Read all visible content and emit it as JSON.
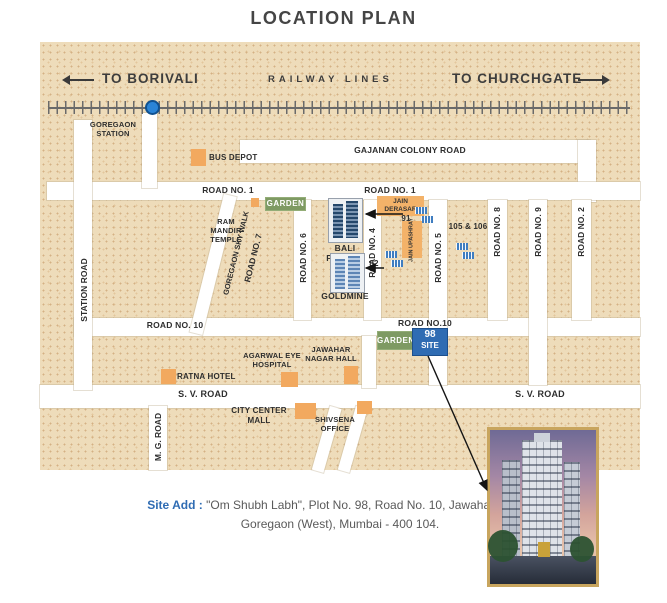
{
  "title": "LOCATION PLAN",
  "railway": {
    "to_borivali": "TO BORIVALI",
    "lines_label": "RAILWAY LINES",
    "to_churchgate": "TO CHURCHGATE",
    "station": "GOREGAON STATION"
  },
  "roads": {
    "gajanan": "GAJANAN COLONY ROAD",
    "road1_west": "ROAD NO. 1",
    "road1_east": "ROAD NO. 1",
    "road2": "ROAD NO. 2",
    "road4": "ROAD NO. 4",
    "road5": "ROAD NO. 5",
    "road6": "ROAD NO. 6",
    "road7": "ROAD NO. 7",
    "road8": "ROAD NO. 8",
    "road9": "ROAD NO. 9",
    "road10_west": "ROAD NO. 10",
    "road10_east": "ROAD NO.10",
    "station_road": "STATION ROAD",
    "mg_road": "M. G. ROAD",
    "sv_road_west": "S. V. ROAD",
    "sv_road_east": "S. V. ROAD",
    "skywalk": "GOREGAON SKY WALK"
  },
  "landmarks": {
    "bus_depot": "BUS DEPOT",
    "garden_north": "GARDEN",
    "garden_south": "GARDEN",
    "ram_mandir": "RAM MANDIR TEMPLE",
    "bali_prabhu": "BALI PRABHU",
    "goldmine": "GOLDMINE",
    "jain_derasar": "JAIN DERASAR",
    "jain_upashray": "JAIN UPASHRAY",
    "plot_91": "91",
    "plot_82": "82",
    "plot_105_106": "105 & 106",
    "jawahar_hall": "JAWAHAR NAGAR HALL",
    "agarwal_hospital": "AGARWAL EYE HOSPITAL",
    "ratna_hotel": "RATNA HOTEL",
    "city_center_mall": "CITY CENTER MALL",
    "shivsena_office": "SHIVSENA OFFICE"
  },
  "site": {
    "number": "98",
    "label": "SITE"
  },
  "address": {
    "label": "Site Add :",
    "line1": "\"Om Shubh Labh\", Plot No. 98, Road No. 10, Jawahar Nagar,",
    "line2": "Goregaon (West), Mumbai - 400 104."
  },
  "colors": {
    "map_bg": "#eedcba",
    "road": "#ffffff",
    "landmark_orange": "#f2a95f",
    "garden_green": "#7e9a63",
    "site_blue": "#2f6cb3",
    "station_dot": "#2b84d6",
    "accent_text": "#2f6cb3"
  }
}
